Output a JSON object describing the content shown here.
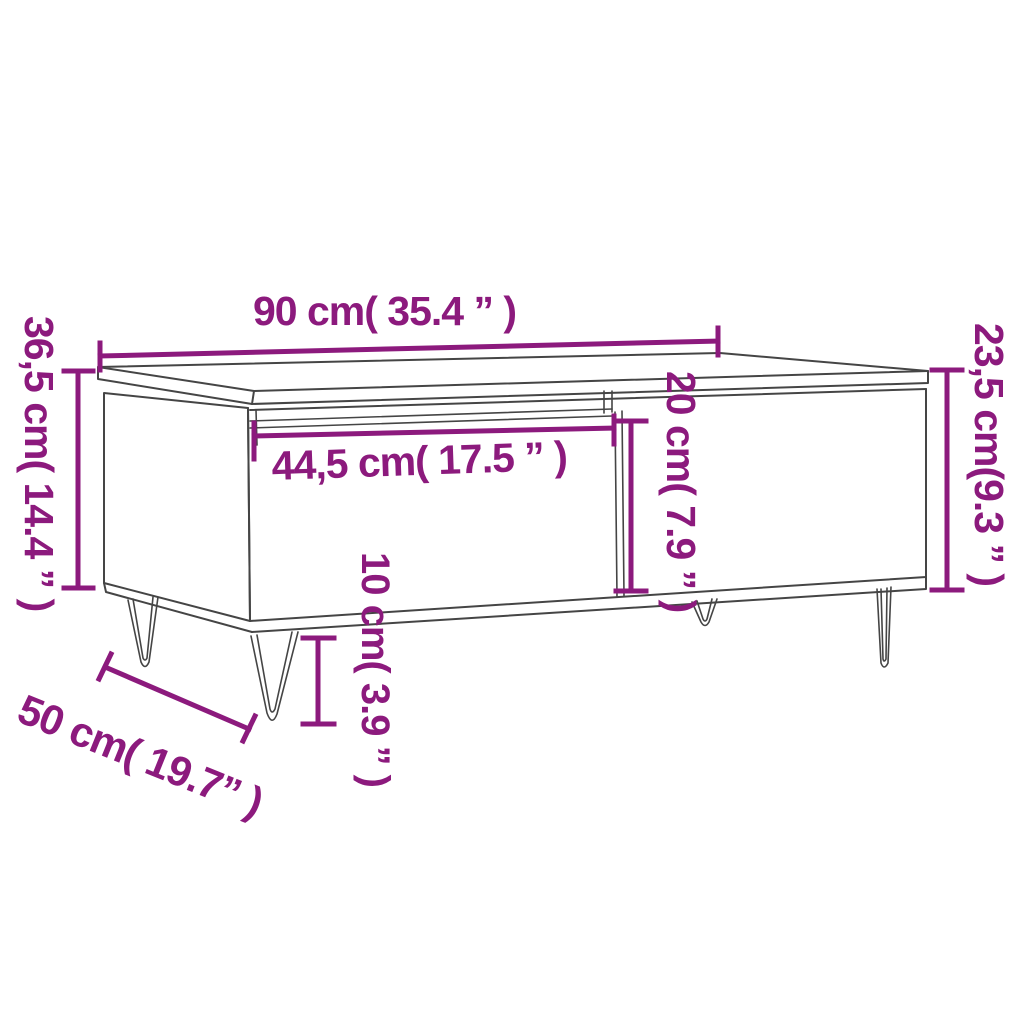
{
  "figure": {
    "type": "furniture-dimension-diagram",
    "subject": "coffee table with drawer and hairpin legs"
  },
  "colors": {
    "accent": "#8C1A7D",
    "line": "#454545",
    "background": "#FFFFFF"
  },
  "dimensions": {
    "top_width": "90 cm( 35.4 ” )",
    "left_height": "36,5 cm( 14.4 ” )",
    "right_height": "23,5 cm(9.3 ” )",
    "drawer_width": "44,5 cm( 17.5 ” )",
    "drawer_height": "20 cm( 7.9 ” )",
    "leg_height": "10 cm( 3.9 ” )",
    "depth": "50 cm( 19.7” )"
  }
}
